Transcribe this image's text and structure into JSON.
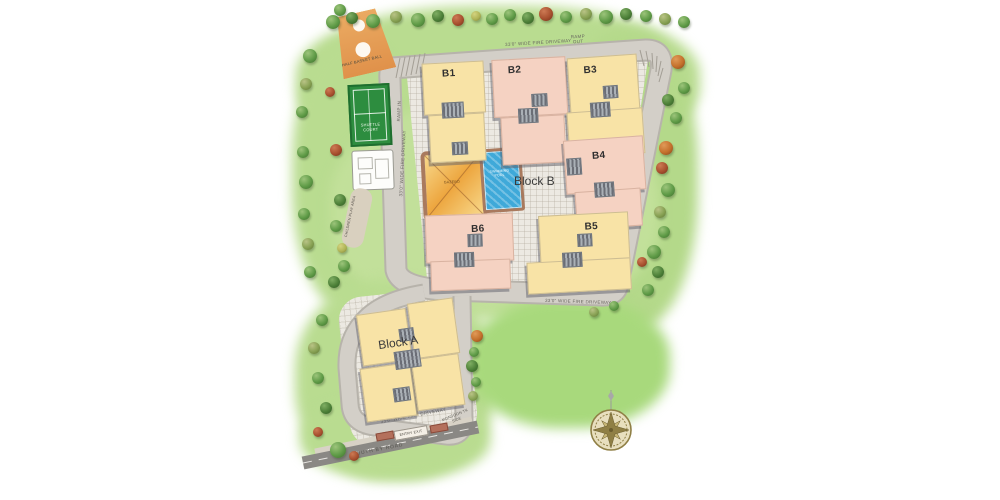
{
  "site": {
    "blocks": {
      "b1": "B1",
      "b2": "B2",
      "b3": "B3",
      "b4": "B4",
      "b5": "B5",
      "b6": "B6",
      "block_a": "Block A",
      "block_b": "Block B"
    },
    "amenities": {
      "half_basketball": "HALF BASKET BALL",
      "shuttle_court": "SHUTTLE COURT",
      "children_play_area": "CHILDREN PLAY AREA",
      "swimming_pool": "SWIMMING POOL",
      "gazebo": "GAZEBO"
    },
    "roads": {
      "fire_driveway": "33'0\" WIDE FIRE DRIVEWAY",
      "ramp_in": "RAMP IN",
      "ramp_out": "RAMP OUT",
      "south_road": "SOUTH BY ROAD",
      "gate": "ENTRY EXIT",
      "monsoon": "MONSOON TK SIDE"
    },
    "icons": {
      "tree": "tree-icon",
      "compass": "compass-rose-icon"
    },
    "colors": {
      "yellow_building": "#f8e3a6",
      "pink_building": "#f5d2c2",
      "pool_water": "#3fa9d9",
      "lawn_green": "#b9dc90",
      "road_grey": "#d3cfc8",
      "south_road_grey": "#8a8884",
      "court_green": "#2d8d3f",
      "basketball_orange": "#e0914a",
      "compass_gold": "#8f7f45"
    }
  }
}
